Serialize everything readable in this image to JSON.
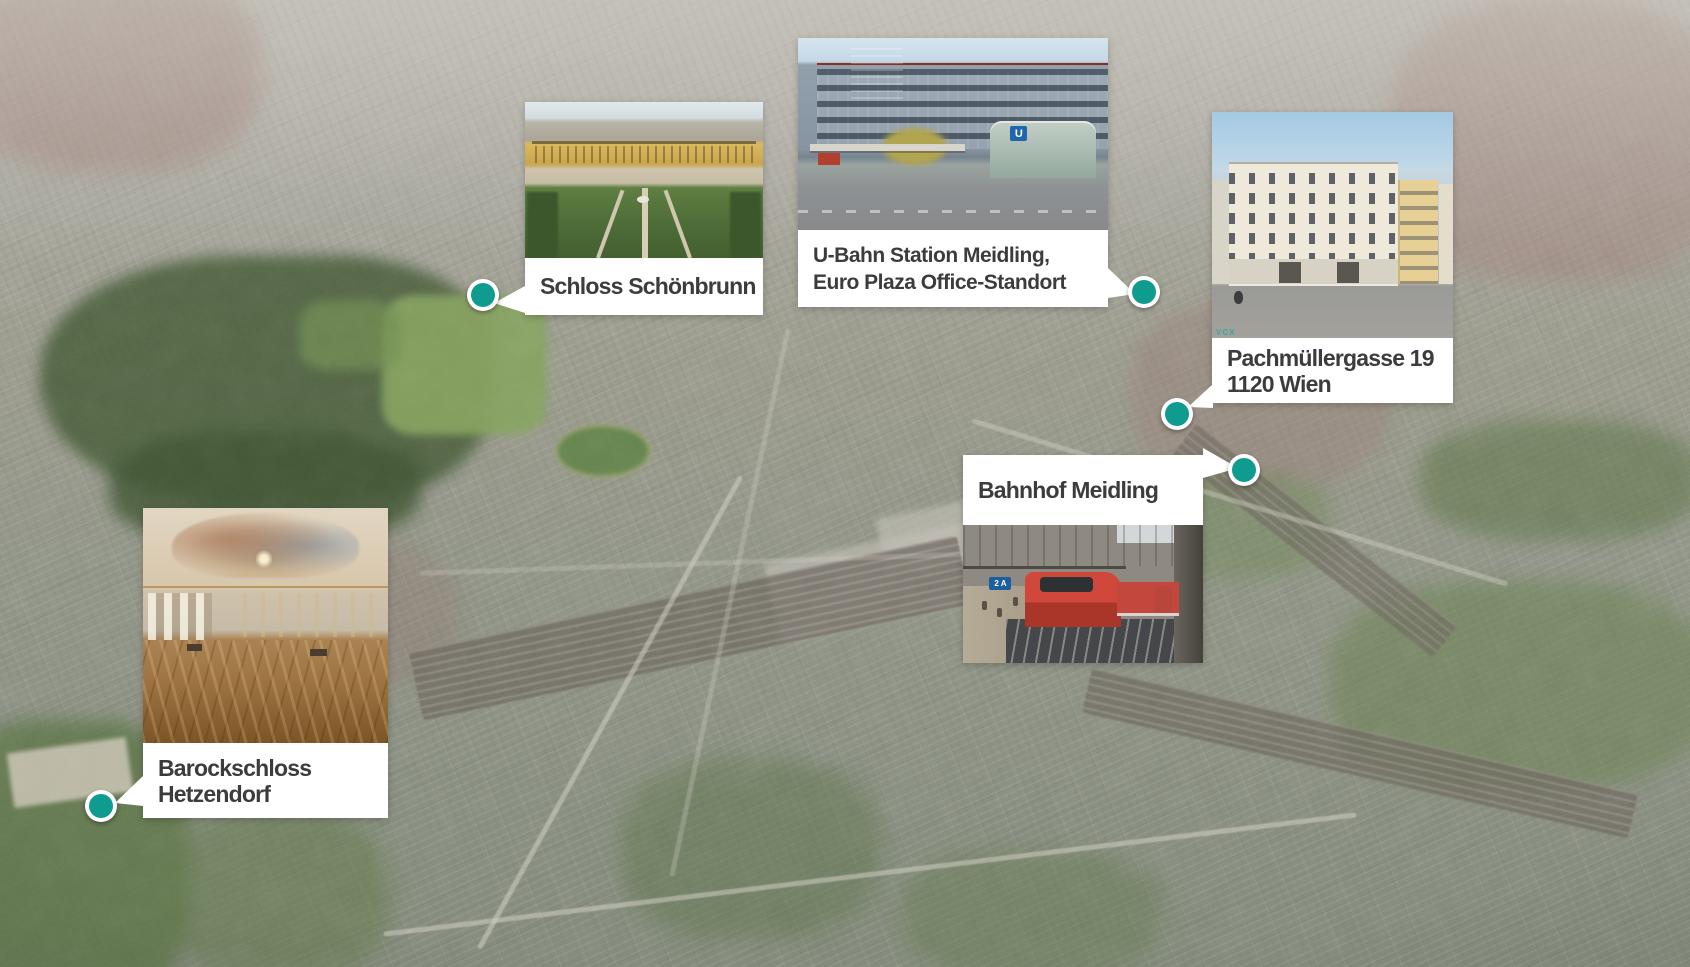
{
  "colors": {
    "marker": "#109B8F",
    "label_text": "#3C3C3E",
    "label_bg": "#FFFFFF"
  },
  "callouts": [
    {
      "id": "schloss-schoenbrunn",
      "lines": [
        "Schloss Schönbrunn"
      ]
    },
    {
      "id": "u-bahn-station-meidling",
      "lines": [
        "U-Bahn Station Meidling,",
        "Euro Plaza Office-Standort"
      ]
    },
    {
      "id": "pachmuellergasse-19",
      "lines": [
        "Pachmüllergasse 19",
        "1120 Wien"
      ]
    },
    {
      "id": "bahnhof-meidling",
      "lines": [
        "Bahnhof Meidling"
      ]
    },
    {
      "id": "barockschloss-hetzendorf",
      "lines": [
        "Barockschloss",
        "Hetzendorf"
      ]
    }
  ],
  "photo_texts": {
    "ubahn_sign": "U",
    "bahnhof_platform_sign": "2 A",
    "pach_watermark": "VCX"
  }
}
